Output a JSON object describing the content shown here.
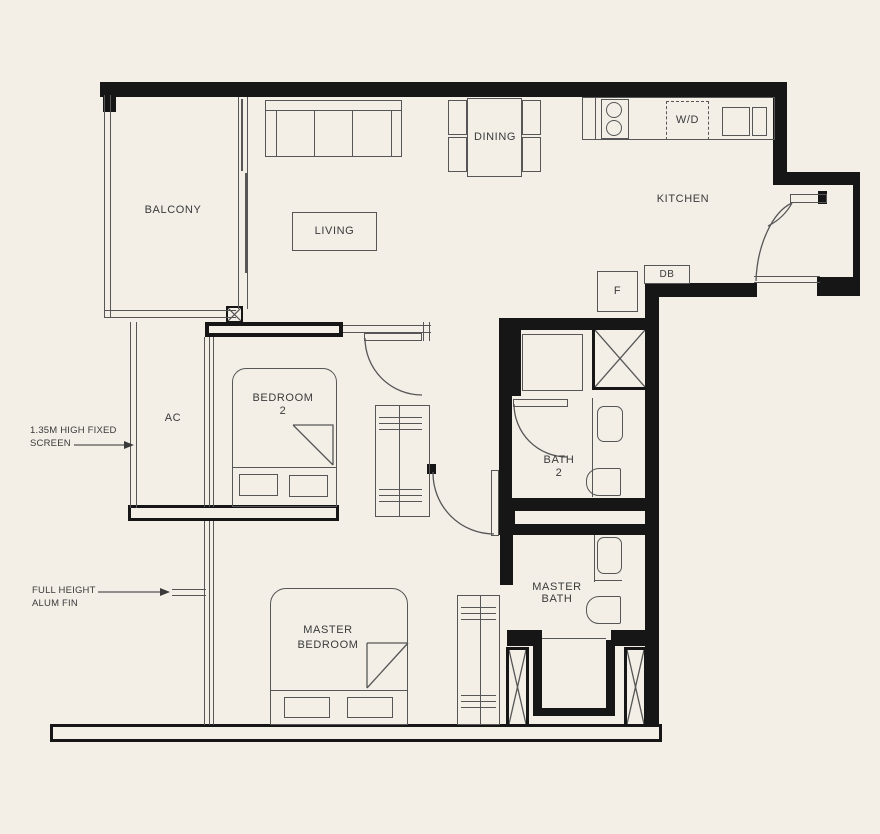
{
  "plan": {
    "rooms": {
      "balcony": "BALCONY",
      "living": "LIVING",
      "dining": "DINING",
      "kitchen": "KITCHEN",
      "ac": "AC",
      "bedroom2_line1": "BEDROOM",
      "bedroom2_line2": "2",
      "bath2_line1": "BATH",
      "bath2_line2": "2",
      "master_bath_line1": "MASTER",
      "master_bath_line2": "BATH",
      "master_bedroom_line1": "MASTER",
      "master_bedroom_line2": "BEDROOM"
    },
    "fixtures": {
      "washer_dryer": "W/D",
      "fridge": "F",
      "distribution_board": "DB"
    },
    "annotations": {
      "fixed_screen_line1": "1.35M HIGH FIXED",
      "fixed_screen_line2": "SCREEN",
      "alum_fin_line1": "FULL HEIGHT",
      "alum_fin_line2": "ALUM FIN"
    },
    "colors": {
      "background": "#f3efe7",
      "wall": "#161616",
      "line": "#565656",
      "text": "#3a3a3a"
    }
  }
}
